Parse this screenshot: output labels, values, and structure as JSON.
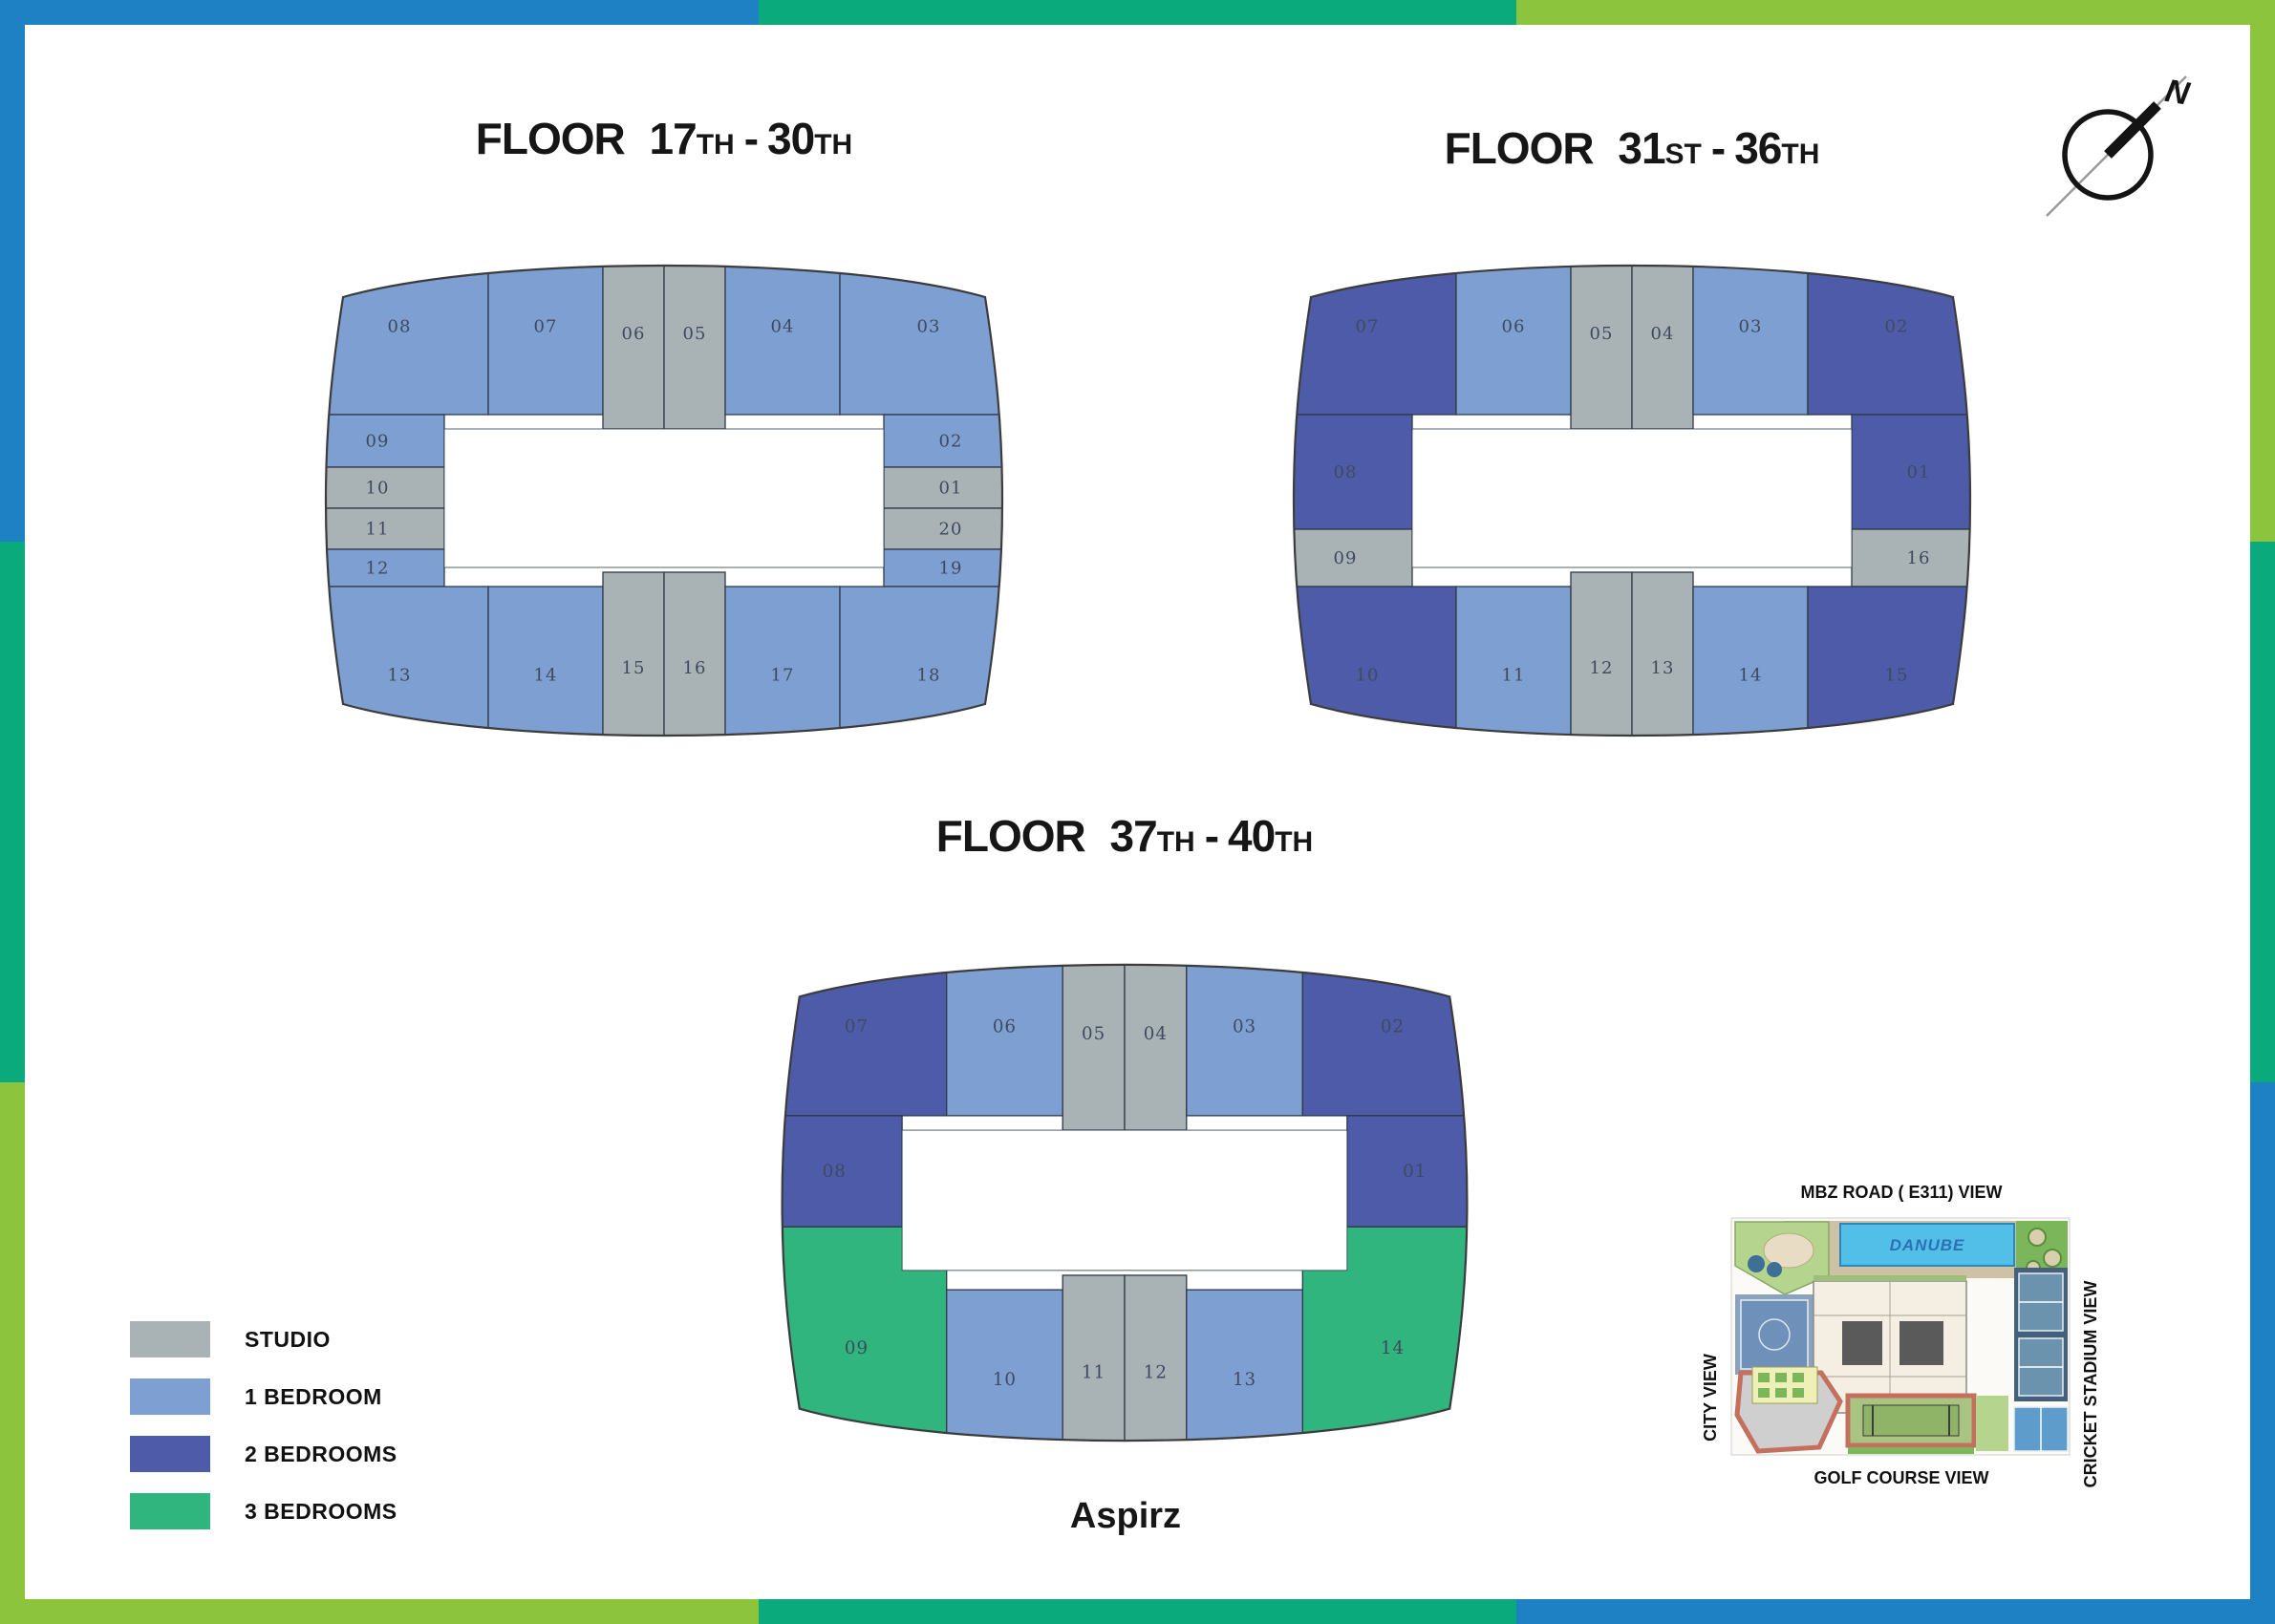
{
  "frame": {
    "blue": "#1e81c4",
    "teal": "#0baa7c",
    "green": "#8cc43d"
  },
  "unit_colors": {
    "studio": "#a9b3b5",
    "br1": "#7e9fd2",
    "br2": "#4e5ba8",
    "br3": "#2fb57d"
  },
  "unit_label_color": "#3e4a5e",
  "legend": {
    "items": [
      {
        "type": "studio",
        "label": "STUDIO"
      },
      {
        "type": "br1",
        "label": "1 BEDROOM"
      },
      {
        "type": "br2",
        "label": "2 BEDROOMS"
      },
      {
        "type": "br3",
        "label": "3 BEDROOMS"
      }
    ]
  },
  "compass": {
    "north_label": "N"
  },
  "brand": {
    "name": "Aspirz"
  },
  "site_map": {
    "top_label": "MBZ ROAD ( E311) VIEW",
    "left_label": "CITY VIEW",
    "right_label": "CRICKET STADIUM VIEW",
    "bottom_label": "GOLF COURSE VIEW",
    "pool_label": "DANUBE"
  },
  "plans": [
    {
      "id": "floor-17-30",
      "title": {
        "word": "FLOOR",
        "from": "17",
        "from_suffix": "TH",
        "dash": "-",
        "to": "30",
        "to_suffix": "TH"
      },
      "units": [
        {
          "num": "08",
          "type": "br1",
          "rect": [
            30,
            0,
            186,
            185
          ]
        },
        {
          "num": "07",
          "type": "br1",
          "rect": [
            216,
            0,
            120,
            185
          ]
        },
        {
          "num": "06",
          "type": "studio",
          "rect": [
            336,
            0,
            64,
            200
          ]
        },
        {
          "num": "05",
          "type": "studio",
          "rect": [
            400,
            0,
            64,
            200
          ]
        },
        {
          "num": "04",
          "type": "br1",
          "rect": [
            464,
            0,
            120,
            185
          ]
        },
        {
          "num": "03",
          "type": "br1",
          "rect": [
            584,
            0,
            186,
            185
          ]
        },
        {
          "num": "02",
          "type": "br1",
          "rect": [
            630,
            185,
            140,
            55
          ]
        },
        {
          "num": "01",
          "type": "studio",
          "rect": [
            630,
            240,
            140,
            43
          ]
        },
        {
          "num": "20",
          "type": "studio",
          "rect": [
            630,
            283,
            140,
            43
          ]
        },
        {
          "num": "19",
          "type": "br1",
          "rect": [
            630,
            326,
            140,
            39
          ]
        },
        {
          "num": "09",
          "type": "br1",
          "rect": [
            30,
            185,
            140,
            55
          ]
        },
        {
          "num": "10",
          "type": "studio",
          "rect": [
            30,
            240,
            140,
            43
          ]
        },
        {
          "num": "11",
          "type": "studio",
          "rect": [
            30,
            283,
            140,
            43
          ]
        },
        {
          "num": "12",
          "type": "br1",
          "rect": [
            30,
            326,
            140,
            39
          ]
        },
        {
          "num": "13",
          "type": "br1",
          "rect": [
            30,
            365,
            186,
            185
          ]
        },
        {
          "num": "14",
          "type": "br1",
          "rect": [
            216,
            365,
            120,
            185
          ]
        },
        {
          "num": "15",
          "type": "studio",
          "rect": [
            336,
            350,
            64,
            200
          ]
        },
        {
          "num": "16",
          "type": "studio",
          "rect": [
            400,
            350,
            64,
            200
          ]
        },
        {
          "num": "17",
          "type": "br1",
          "rect": [
            464,
            365,
            120,
            185
          ]
        },
        {
          "num": "18",
          "type": "br1",
          "rect": [
            584,
            365,
            186,
            185
          ]
        }
      ]
    },
    {
      "id": "floor-31-36",
      "title": {
        "word": "FLOOR",
        "from": "31",
        "from_suffix": "ST",
        "dash": "-",
        "to": "36",
        "to_suffix": "TH"
      },
      "units": [
        {
          "num": "07",
          "type": "br2",
          "rect": [
            30,
            0,
            186,
            185
          ]
        },
        {
          "num": "06",
          "type": "br1",
          "rect": [
            216,
            0,
            120,
            185
          ]
        },
        {
          "num": "05",
          "type": "studio",
          "rect": [
            336,
            0,
            64,
            200
          ]
        },
        {
          "num": "04",
          "type": "studio",
          "rect": [
            400,
            0,
            64,
            200
          ]
        },
        {
          "num": "03",
          "type": "br1",
          "rect": [
            464,
            0,
            120,
            185
          ]
        },
        {
          "num": "02",
          "type": "br2",
          "rect": [
            584,
            0,
            186,
            185
          ]
        },
        {
          "num": "08",
          "type": "br2",
          "rect": [
            30,
            185,
            140,
            120
          ]
        },
        {
          "num": "09",
          "type": "studio",
          "rect": [
            30,
            305,
            140,
            60
          ]
        },
        {
          "num": "01",
          "type": "br2",
          "rect": [
            630,
            185,
            140,
            120
          ]
        },
        {
          "num": "16",
          "type": "studio",
          "rect": [
            630,
            305,
            140,
            60
          ]
        },
        {
          "num": "10",
          "type": "br2",
          "rect": [
            30,
            365,
            186,
            185
          ]
        },
        {
          "num": "11",
          "type": "br1",
          "rect": [
            216,
            365,
            120,
            185
          ]
        },
        {
          "num": "12",
          "type": "studio",
          "rect": [
            336,
            350,
            64,
            200
          ]
        },
        {
          "num": "13",
          "type": "studio",
          "rect": [
            400,
            350,
            64,
            200
          ]
        },
        {
          "num": "14",
          "type": "br1",
          "rect": [
            464,
            365,
            120,
            185
          ]
        },
        {
          "num": "15",
          "type": "br2",
          "rect": [
            584,
            365,
            186,
            185
          ]
        }
      ]
    },
    {
      "id": "floor-37-40",
      "title": {
        "word": "FLOOR",
        "from": "37",
        "from_suffix": "TH",
        "dash": "-",
        "to": "40",
        "to_suffix": "TH"
      },
      "units": [
        {
          "num": "07",
          "type": "br2",
          "rect": [
            30,
            0,
            186,
            185
          ]
        },
        {
          "num": "06",
          "type": "br1",
          "rect": [
            216,
            0,
            120,
            185
          ]
        },
        {
          "num": "05",
          "type": "studio",
          "rect": [
            336,
            0,
            64,
            200
          ]
        },
        {
          "num": "04",
          "type": "studio",
          "rect": [
            400,
            0,
            64,
            200
          ]
        },
        {
          "num": "03",
          "type": "br1",
          "rect": [
            464,
            0,
            120,
            185
          ]
        },
        {
          "num": "02",
          "type": "br2",
          "rect": [
            584,
            0,
            186,
            185
          ]
        },
        {
          "num": "08",
          "type": "br2",
          "rect": [
            30,
            185,
            140,
            115
          ]
        },
        {
          "num": "01",
          "type": "br2",
          "rect": [
            630,
            185,
            140,
            115
          ]
        },
        {
          "num": "09",
          "type": "br3",
          "rect": [
            30,
            300,
            186,
            250
          ]
        },
        {
          "num": "14",
          "type": "br3",
          "rect": [
            584,
            300,
            186,
            250
          ]
        },
        {
          "num": "10",
          "type": "br1",
          "rect": [
            216,
            365,
            120,
            185
          ]
        },
        {
          "num": "11",
          "type": "studio",
          "rect": [
            336,
            350,
            64,
            200
          ]
        },
        {
          "num": "12",
          "type": "studio",
          "rect": [
            400,
            350,
            64,
            200
          ]
        },
        {
          "num": "13",
          "type": "br1",
          "rect": [
            464,
            365,
            120,
            185
          ]
        }
      ]
    }
  ]
}
